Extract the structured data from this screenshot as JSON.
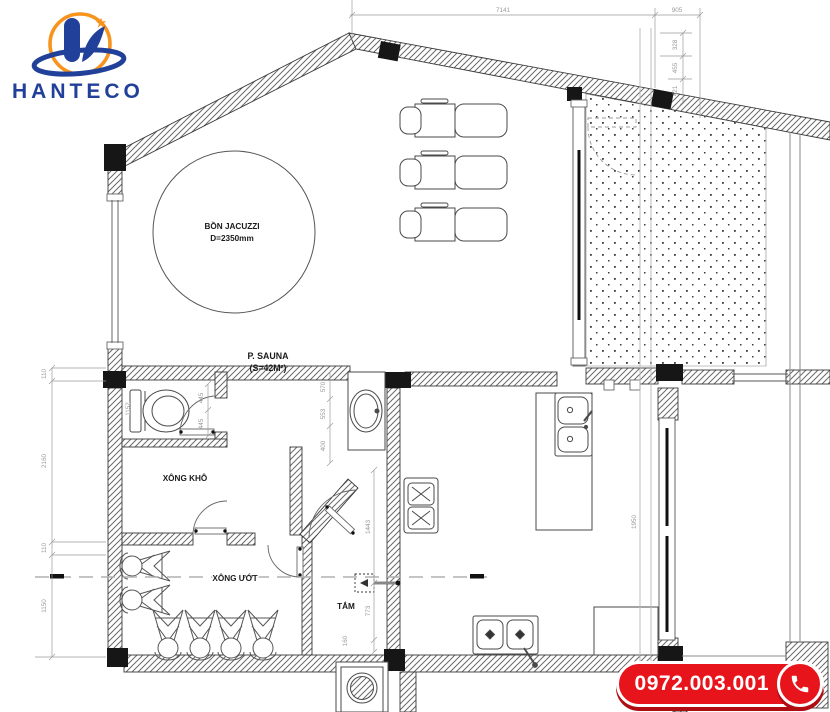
{
  "brand": {
    "name": "HANTECO"
  },
  "contact": {
    "phone": "0972.003.001"
  },
  "rooms": {
    "jacuzzi_line1": "BỒN JACUZZI",
    "jacuzzi_line2": "D=2350mm",
    "sauna_line1": "P. SAUNA",
    "sauna_line2": "(S=42M²)",
    "dry_steam": "XÔNG KHÔ",
    "wet_steam": "XÔNG ƯỚT",
    "bath": "TẮM"
  },
  "dims": {
    "top_main": "7141",
    "top_right": "905",
    "right_1": "328",
    "right_2": "455",
    "right_3": "421",
    "left_1": "110",
    "left_2": "2160",
    "left_3": "110",
    "left_4": "1150",
    "vanity_1": "570",
    "vanity_2": "553",
    "vanity_3": "400",
    "wc_1": "445",
    "wc_2": "445",
    "wc_3": "1152",
    "bath_1": "1443",
    "bath_2": "773",
    "bath_3": "160",
    "kitchen_1": "1950"
  },
  "colors": {
    "brand_blue": "#21409a",
    "accent_orange": "#f7941e",
    "phone_red": "#e8141b",
    "wall_line": "#444444",
    "dim_gray": "#999999"
  }
}
